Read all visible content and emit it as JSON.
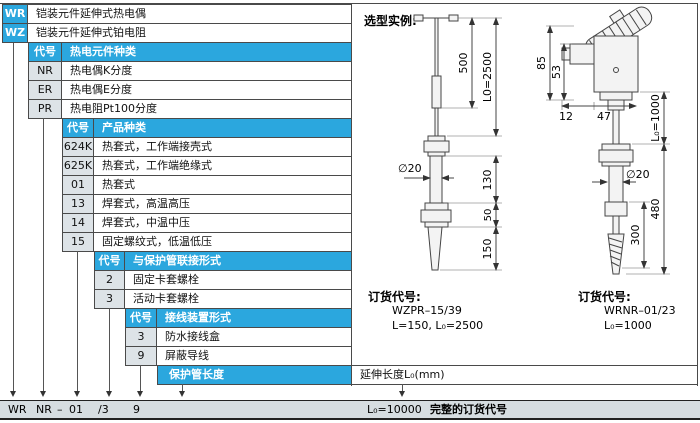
{
  "colors": {
    "accent_cyan": "#2ba7de",
    "code_cell_bg": "#dde3e7",
    "bottom_bar_bg": "#d6dde1",
    "border": "#4a4a4a"
  },
  "catalog": {
    "top_rows": [
      {
        "code": "WR",
        "desc": "铠装元件延伸式热电偶"
      },
      {
        "code": "WZ",
        "desc": "铠装元件延伸式铂电阻"
      }
    ],
    "sections": [
      {
        "code_header": "代号",
        "title": "热电元件种类",
        "rows": [
          {
            "code": "NR",
            "desc": "热电偶K分度"
          },
          {
            "code": "ER",
            "desc": "热电偶E分度"
          },
          {
            "code": "PR",
            "desc": "热电阻Pt100分度"
          }
        ]
      },
      {
        "code_header": "代号",
        "title": "产品种类",
        "rows": [
          {
            "code": "624K",
            "desc": "热套式，工作端接壳式"
          },
          {
            "code": "625K",
            "desc": "热套式，工作端绝缘式"
          },
          {
            "code": "01",
            "desc": "热套式"
          },
          {
            "code": "13",
            "desc": "焊套式，高温高压"
          },
          {
            "code": "14",
            "desc": "焊套式，中温中压"
          },
          {
            "code": "15",
            "desc": "固定螺纹式，低温低压"
          }
        ]
      },
      {
        "code_header": "代号",
        "title": "与保护管联接形式",
        "rows": [
          {
            "code": "2",
            "desc": "固定卡套螺栓"
          },
          {
            "code": "3",
            "desc": "活动卡套螺栓"
          }
        ]
      },
      {
        "code_header": "代号",
        "title": "接线装置形式",
        "rows": [
          {
            "code": "3",
            "desc": "防水接线盒"
          },
          {
            "code": "9",
            "desc": "屏蔽导线"
          }
        ]
      }
    ],
    "length_row": {
      "title": "保护管长度",
      "value": "延伸长度L₀(mm)"
    }
  },
  "example": {
    "title": "选型实例:",
    "left": {
      "dim_upper": "500",
      "dim_total": "L0=2500",
      "dim_dia": "∅20",
      "dim_mid": "130",
      "dim_nut": "50",
      "dim_tip": "150",
      "order_label": "订货代号:",
      "order_code": "WZPR–15/39",
      "order_params": "L=150, L₀=2500"
    },
    "right": {
      "dim_h1": "85",
      "dim_h2": "53",
      "dim_w1": "12",
      "dim_w2": "47",
      "dim_l0": "L₀=1000",
      "dim_dia": "∅20",
      "dim_480": "480",
      "dim_300": "300",
      "order_label": "订货代号:",
      "order_code": "WRNR–01/23",
      "order_params": "L₀=1000"
    }
  },
  "bar": {
    "codes": [
      "WR",
      "NR",
      "–",
      "01",
      "/3",
      "9"
    ],
    "length_code": "L₀=10000",
    "label": "完整的订货代号"
  }
}
